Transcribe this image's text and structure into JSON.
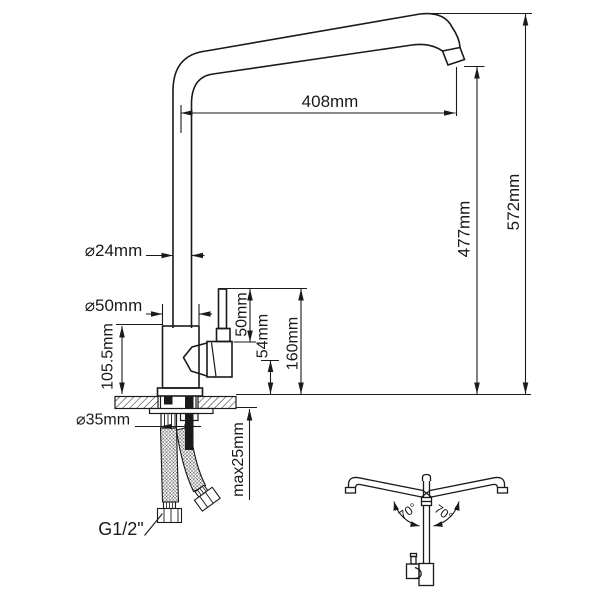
{
  "title": "Kitchen faucet technical dimension drawing",
  "labels": {
    "spout_reach": "408mm",
    "outlet_height": "477mm",
    "overall_height": "572mm",
    "pipe_diameter": "⌀24mm",
    "body_diameter": "⌀50mm",
    "body_height": "105.5mm",
    "lever_length": "50mm",
    "handle_height": "54mm",
    "lever_top_height": "160mm",
    "hole_diameter": "⌀35mm",
    "max_mounting_thickness": "max25mm",
    "thread_size": "G1/2\"",
    "swivel_angle_left": "70°",
    "swivel_angle_right": "70°"
  },
  "colors": {
    "line": "#1a1a1a",
    "background": "#ffffff"
  }
}
